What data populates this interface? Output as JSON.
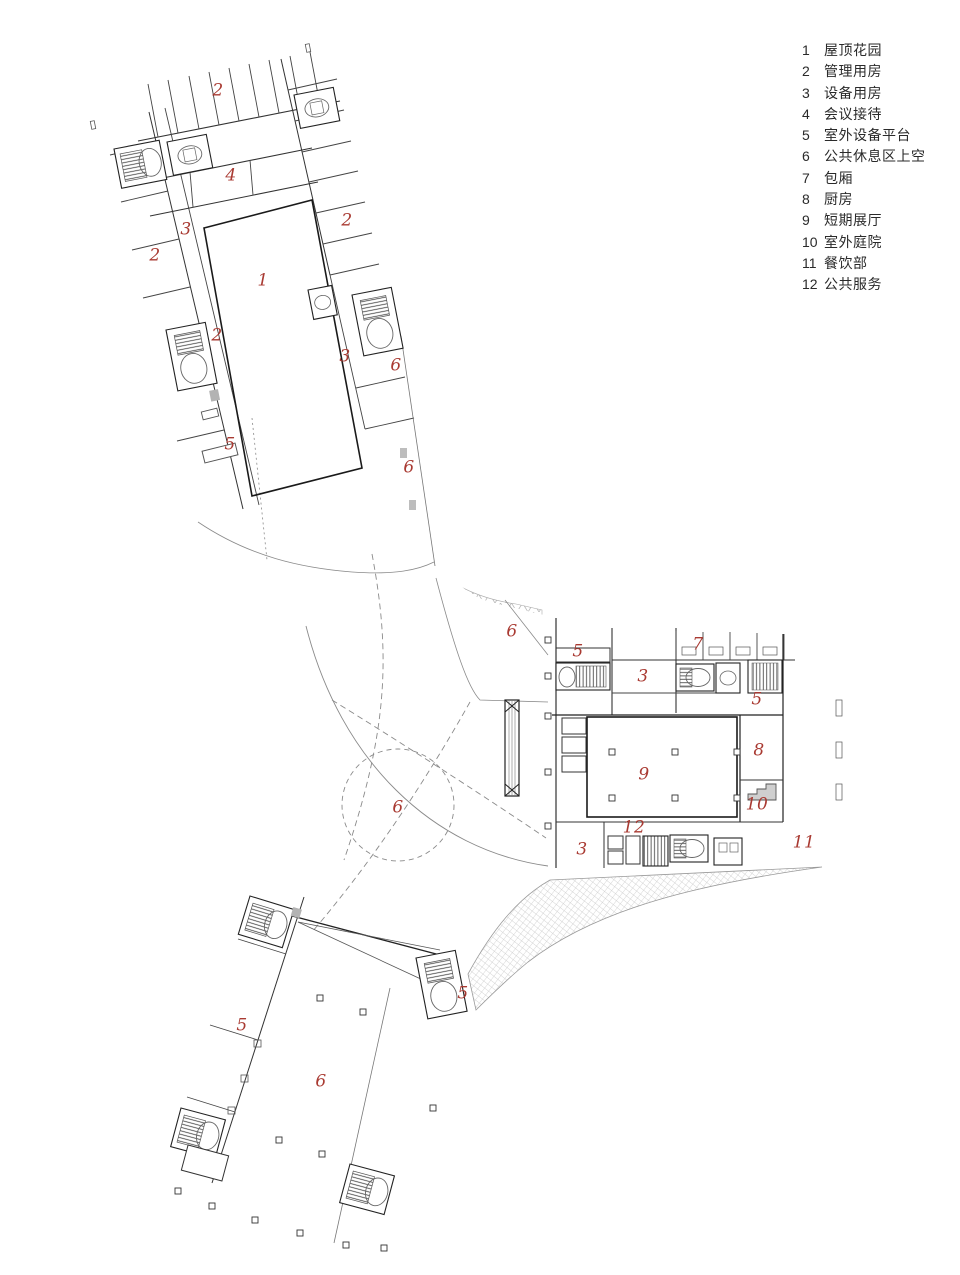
{
  "meta": {
    "drawing_type": "architectural floor plan",
    "background_color": "#ffffff",
    "room_label_color": "#a93a32",
    "legend_text_color": "#2a2a2a",
    "wall_color": "#1a1a1a"
  },
  "legend": {
    "position": {
      "left": 802,
      "top": 40
    },
    "items": [
      {
        "num": "1",
        "label": "屋顶花园"
      },
      {
        "num": "2",
        "label": "管理用房"
      },
      {
        "num": "3",
        "label": "设备用房"
      },
      {
        "num": "4",
        "label": "会议接待"
      },
      {
        "num": "5",
        "label": "室外设备平台"
      },
      {
        "num": "6",
        "label": "公共休息区上空"
      },
      {
        "num": "7",
        "label": "包厢"
      },
      {
        "num": "8",
        "label": "厨房"
      },
      {
        "num": "9",
        "label": "短期展厅"
      },
      {
        "num": "10",
        "label": "室外庭院"
      },
      {
        "num": "11",
        "label": "餐饮部"
      },
      {
        "num": "12",
        "label": "公共服务"
      }
    ]
  },
  "plan": {
    "room_labels": [
      {
        "text": "2",
        "x": 218,
        "y": 92
      },
      {
        "text": "4",
        "x": 231,
        "y": 177
      },
      {
        "text": "3",
        "x": 186,
        "y": 231
      },
      {
        "text": "2",
        "x": 155,
        "y": 257
      },
      {
        "text": "2",
        "x": 347,
        "y": 222
      },
      {
        "text": "1",
        "x": 263,
        "y": 282
      },
      {
        "text": "2",
        "x": 217,
        "y": 337
      },
      {
        "text": "3",
        "x": 345,
        "y": 358
      },
      {
        "text": "6",
        "x": 396,
        "y": 367
      },
      {
        "text": "5",
        "x": 230,
        "y": 446
      },
      {
        "text": "6",
        "x": 409,
        "y": 469
      },
      {
        "text": "6",
        "x": 512,
        "y": 633
      },
      {
        "text": "5",
        "x": 578,
        "y": 653
      },
      {
        "text": "7",
        "x": 698,
        "y": 646
      },
      {
        "text": "3",
        "x": 643,
        "y": 678
      },
      {
        "text": "5",
        "x": 757,
        "y": 701
      },
      {
        "text": "8",
        "x": 759,
        "y": 752
      },
      {
        "text": "9",
        "x": 644,
        "y": 776
      },
      {
        "text": "10",
        "x": 757,
        "y": 806
      },
      {
        "text": "6",
        "x": 398,
        "y": 809
      },
      {
        "text": "12",
        "x": 634,
        "y": 829
      },
      {
        "text": "3",
        "x": 582,
        "y": 851
      },
      {
        "text": "11",
        "x": 804,
        "y": 844
      },
      {
        "text": "5",
        "x": 463,
        "y": 995
      },
      {
        "text": "5",
        "x": 242,
        "y": 1027
      },
      {
        "text": "6",
        "x": 321,
        "y": 1083
      }
    ]
  }
}
